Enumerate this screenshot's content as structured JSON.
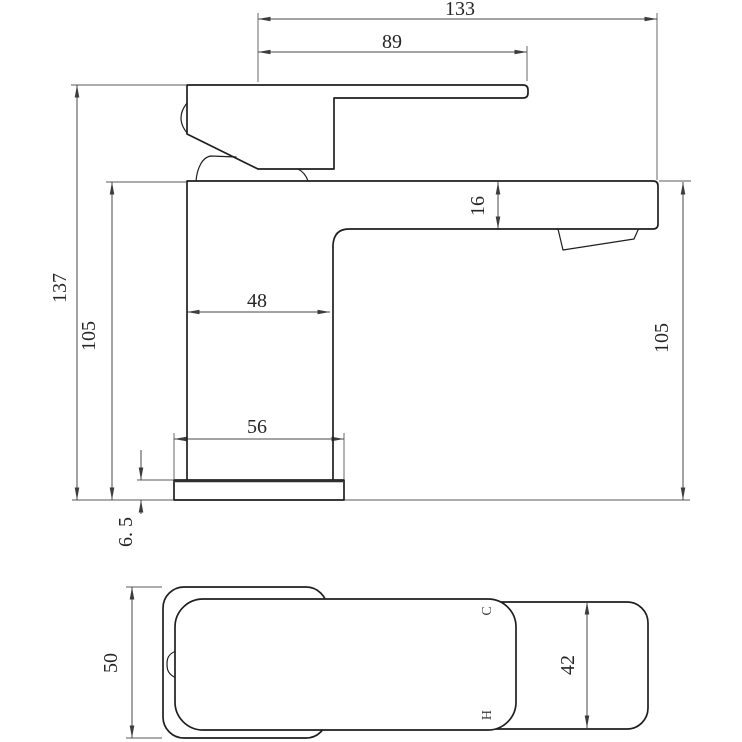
{
  "drawing": {
    "kind": "CAD dimensioned technical drawing",
    "subject": "single-lever basin mixer tap, side elevation and plan view",
    "colors": {
      "background": "#ffffff",
      "outline": "#1f1f1f",
      "dimension_lines": "#474747",
      "text": "#262626"
    },
    "side_view": {
      "name": "side elevation",
      "dimensions": {
        "overall_length": "133",
        "handle_reach": "89",
        "overall_height": "137",
        "height_left": "105",
        "spout_thickness": "16",
        "height_right": "105",
        "body_width": "48",
        "base_width": "56",
        "base_thickness": "6. 5"
      }
    },
    "plan_view": {
      "name": "plan view",
      "dimensions": {
        "body_depth": "50",
        "handle_width": "42"
      },
      "port_markers": {
        "cold": "C",
        "hot": "H"
      }
    }
  }
}
